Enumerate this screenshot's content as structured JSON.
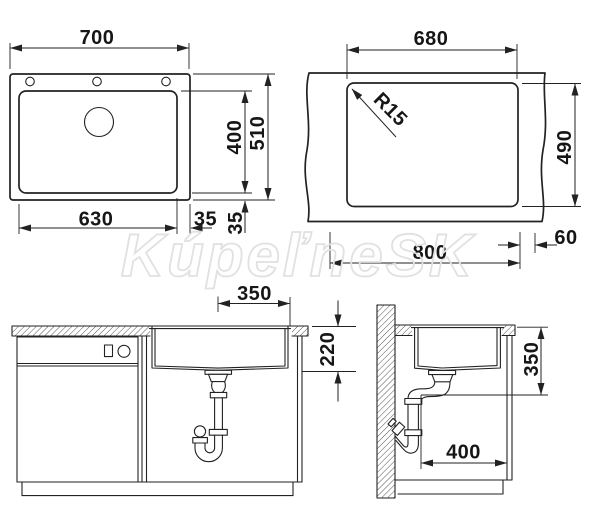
{
  "watermark": {
    "text": "KúpeľneSK"
  },
  "views": {
    "top": {
      "width": "700",
      "bowl_height": "400",
      "total_height": "510",
      "bowl_width": "630",
      "rim_offset_h": "35",
      "rim_offset_v": "35"
    },
    "cutout": {
      "width": "680",
      "corner_radius": "R15",
      "height": "490",
      "base_width": "800",
      "edge_offset": "60"
    },
    "front": {
      "center_to_edge": "350",
      "bowl_depth": "220"
    },
    "side": {
      "drain_height": "350",
      "min_depth": "400"
    }
  },
  "colors": {
    "line": "#222222",
    "dim_text": "#161616",
    "watermark_outline": "#e1e1e1",
    "background": "#ffffff"
  }
}
